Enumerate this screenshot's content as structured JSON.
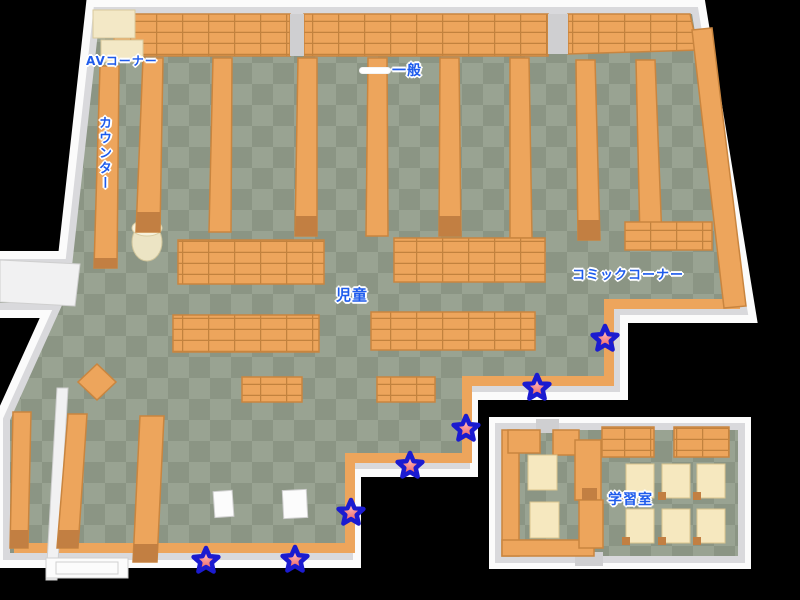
{
  "title": "Library floor map",
  "map": {
    "areas": [
      {
        "id": "av-corner",
        "label": "AVコーナー"
      },
      {
        "id": "counter",
        "label": "カウンター"
      },
      {
        "id": "general",
        "label": "一般"
      },
      {
        "id": "children",
        "label": "児童"
      },
      {
        "id": "comic-corner",
        "label": "コミックコーナー"
      },
      {
        "id": "study-room",
        "label": "学習室"
      }
    ],
    "stars": [
      {
        "x": 206,
        "y": 561
      },
      {
        "x": 295,
        "y": 560
      },
      {
        "x": 351,
        "y": 513
      },
      {
        "x": 410,
        "y": 466
      },
      {
        "x": 466,
        "y": 429
      },
      {
        "x": 537,
        "y": 388
      },
      {
        "x": 605,
        "y": 339
      }
    ],
    "colors": {
      "floor-light": "#99a392",
      "floor-dark": "#8b9584",
      "shelf": "#eda55c",
      "shelf-line": "#c2823e",
      "shelf-edge": "#c9853f",
      "shelf-cap": "#c27f42",
      "wall-white": "#fbfbfb",
      "wall-gray": "#d9d9dc",
      "cream": "#f3e8c6",
      "desk": "#f6e8bf",
      "desk-edge": "#d9c48e",
      "threshold": "#cfcfd1",
      "label-blue": "#1e5bec",
      "star-fill-light": "#ffb0b0",
      "star-fill-dark": "#e54545",
      "star-stroke": "#1b1bd0"
    }
  }
}
